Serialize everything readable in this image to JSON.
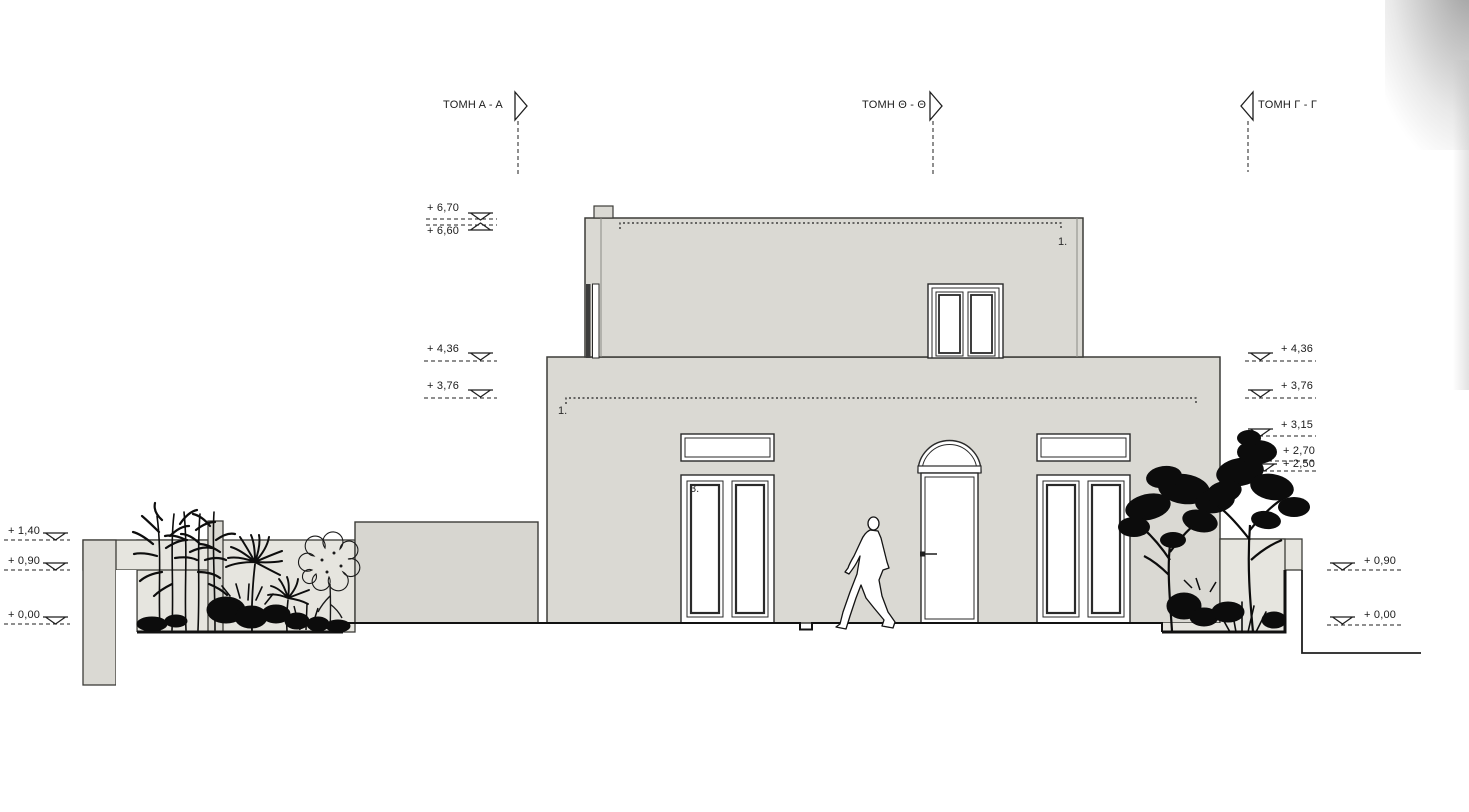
{
  "colors": {
    "wall": "#dad9d3",
    "garden": "#e6e5df",
    "line": "#1f1f1f"
  },
  "section_markers": {
    "a": {
      "label": "ΤΟΜΗ Α - Α",
      "direction": "right"
    },
    "theta": {
      "label": "ΤΟΜΗ Θ - Θ",
      "direction": "right"
    },
    "gamma": {
      "label": "ΤΟΜΗ Γ - Γ",
      "direction": "left"
    }
  },
  "levels": {
    "left": {
      "l670": "+ 6,70",
      "l660": "+ 6,60",
      "l436": "+ 4,36",
      "l376": "+ 3,76",
      "l140": "+ 1,40",
      "l090": "+ 0,90",
      "l000": "+ 0,00"
    },
    "right": {
      "l436": "+ 4,36",
      "l376": "+ 3,76",
      "l315": "+ 3,15",
      "l270": "+ 2,70",
      "l250": "+ 2,50",
      "l090": "+ 0,90",
      "l000": "+ 0,00"
    }
  },
  "annotations": {
    "upper_floor": "1.",
    "ground_floor": "1.",
    "left_door": "3."
  }
}
